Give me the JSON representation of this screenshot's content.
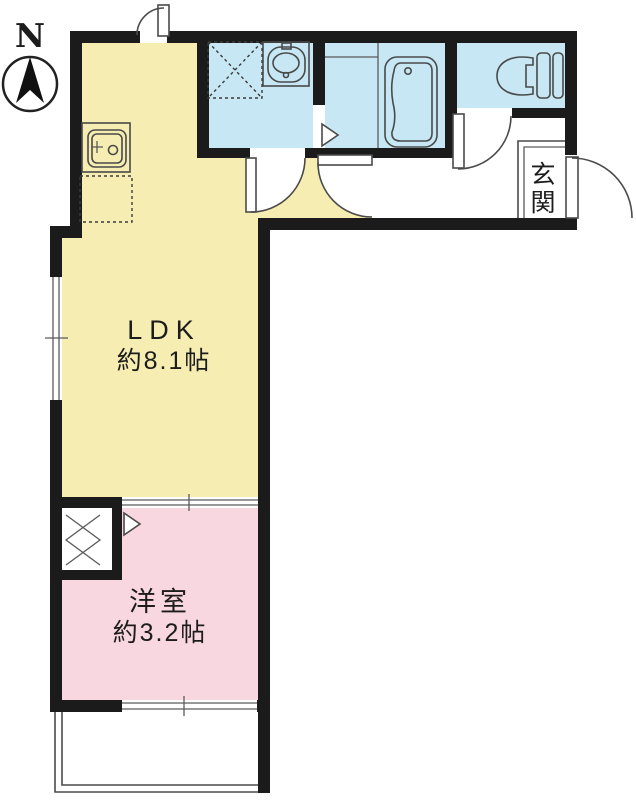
{
  "compass": {
    "label": "N"
  },
  "rooms": {
    "ldk": {
      "name": "LDK",
      "size": "約8.1帖",
      "color": "#F6EDB2"
    },
    "western_room": {
      "name": "洋室",
      "size": "約3.2帖",
      "color": "#F9D7E0"
    },
    "entrance": {
      "name": "玄関"
    },
    "washroom": {
      "color": "#C6E7F3"
    },
    "bathroom": {
      "color": "#C6E7F3"
    },
    "toilet": {
      "color": "#C6E7F3"
    }
  },
  "colors": {
    "wall": "#1b1b1b",
    "line": "#4a4a4a",
    "background": "#FFFFFF"
  }
}
